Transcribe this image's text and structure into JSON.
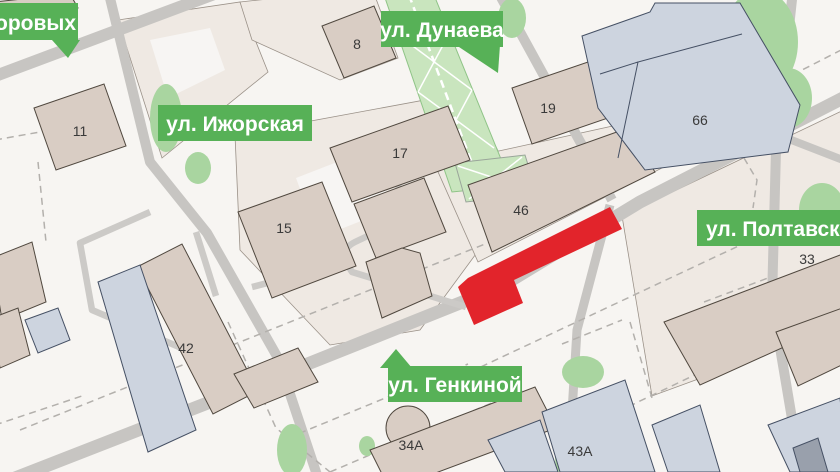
{
  "map": {
    "street_labels": [
      {
        "id": "suvorovykh",
        "text": "воровых"
      },
      {
        "id": "dunaeva",
        "text": "ул. Дунаева"
      },
      {
        "id": "izhorskaya",
        "text": "ул. Ижорская"
      },
      {
        "id": "poltavskaya",
        "text": "ул. Полтавская"
      },
      {
        "id": "genkinoy",
        "text": "ул. Генкиной"
      }
    ],
    "buildings": [
      {
        "number": "8"
      },
      {
        "number": "11"
      },
      {
        "number": "19"
      },
      {
        "number": "17"
      },
      {
        "number": "66"
      },
      {
        "number": "15"
      },
      {
        "number": "46"
      },
      {
        "number": "33"
      },
      {
        "number": "42"
      },
      {
        "number": "34А"
      },
      {
        "number": "43А"
      }
    ],
    "colors": {
      "label_green": "#57B157",
      "highlight_red": "#E2242B",
      "building_beige": "#D9CDC4",
      "building_blue": "#CDD4DF",
      "block_light": "#EFE9E3",
      "vegetation_green": "#A9D5A0",
      "boulevard_green": "#C9E5BE",
      "road_gray": "#C7C5C2",
      "background": "#F7F5F2"
    }
  }
}
